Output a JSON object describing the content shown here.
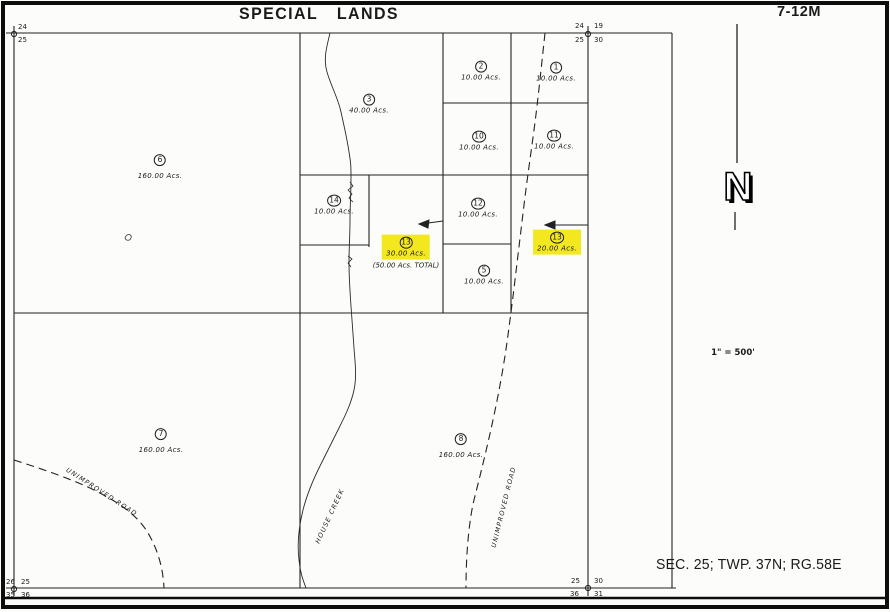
{
  "page": {
    "title": "SPECIAL LANDS",
    "sheet_no": "7-12M",
    "legal": "SEC. 25;  TWP. 37N;  RG.58E",
    "scale": "1\" = 500'",
    "north_letter": "N"
  },
  "labels": {
    "road_left": "UNIMPROVED ROAD",
    "creek": "HOUSE CREEK",
    "road_right": "UNIMPROVED ROAD"
  },
  "corners": {
    "top_left": {
      "a": "24",
      "b": "25"
    },
    "top_right": {
      "a": "24",
      "b": "19",
      "c": "25",
      "d": "30"
    },
    "bottom_left": {
      "a": "26",
      "b": "25",
      "c": "35",
      "d": "36"
    },
    "bottom_right": {
      "a": "25",
      "b": "30",
      "c": "36",
      "d": "31"
    }
  },
  "parcels": [
    {
      "num": "2",
      "acres": "10.00 Acs."
    },
    {
      "num": "1",
      "acres": "10.00 Acs."
    },
    {
      "num": "3",
      "acres": "40.00 Acs."
    },
    {
      "num": "10",
      "acres": "10.00 Acs."
    },
    {
      "num": "11",
      "acres": "10.00 Acs."
    },
    {
      "num": "6",
      "acres": "160.00 Acs."
    },
    {
      "num": "14",
      "acres": "10.00 Acs."
    },
    {
      "num": "12",
      "acres": "10.00 Acs."
    },
    {
      "num": "13",
      "acres": "30.00 Acs.",
      "note": "(50.00 Acs. TOTAL)",
      "highlighted": true
    },
    {
      "num": "13",
      "acres": "20.00 Acs.",
      "highlighted": true
    },
    {
      "num": "5",
      "acres": "10.00 Acs."
    },
    {
      "num": "7",
      "acres": "160.00 Acs."
    },
    {
      "num": "8",
      "acres": "160.00 Acs."
    }
  ],
  "highlight_color": "#f3e81f"
}
